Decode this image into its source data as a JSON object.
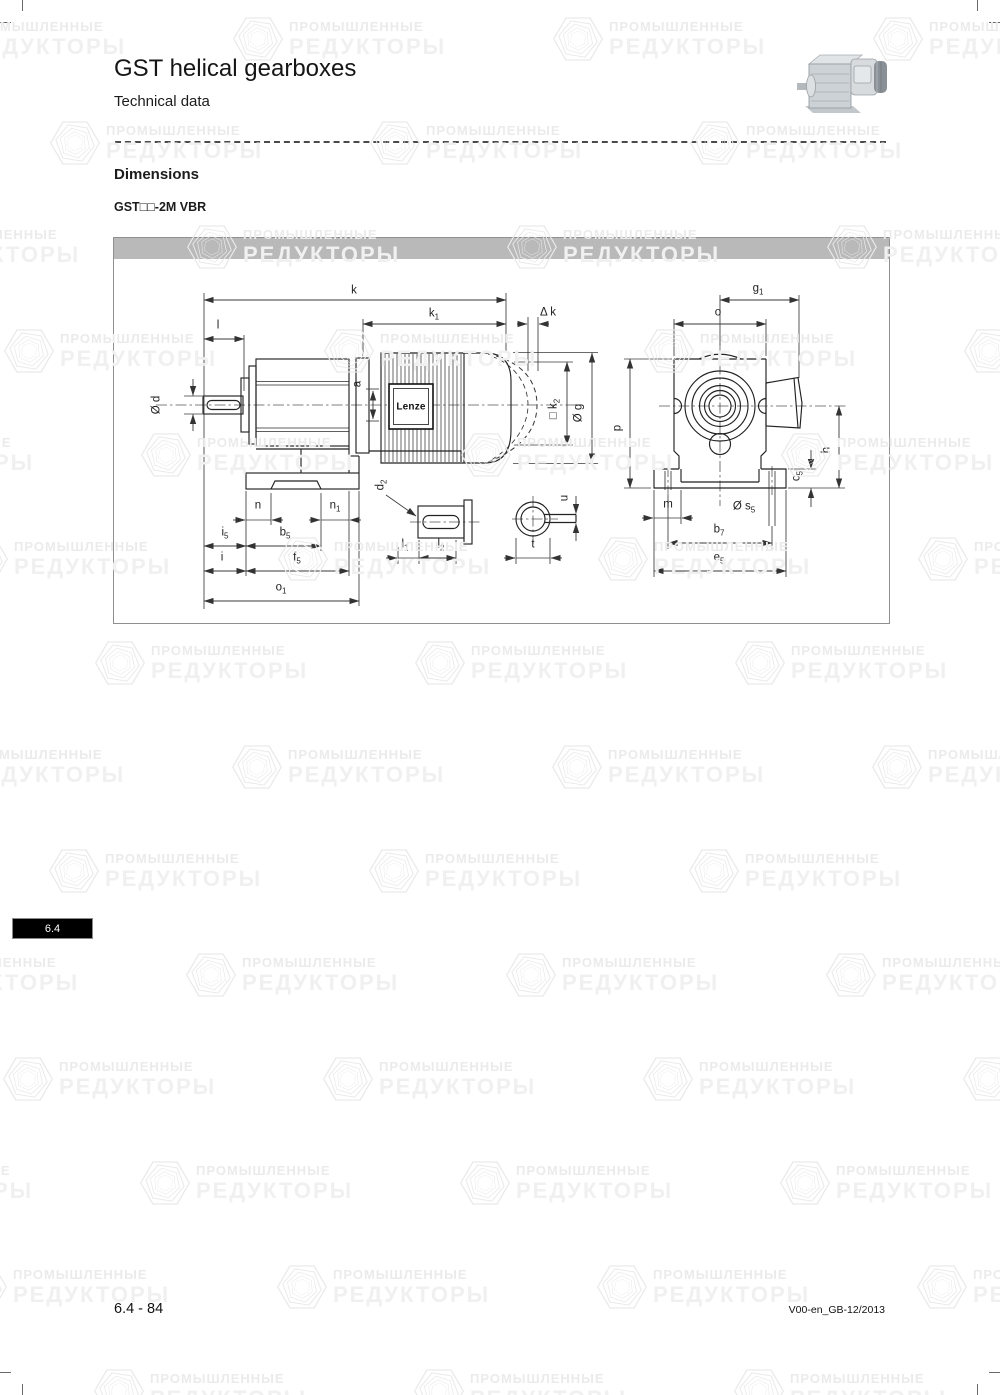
{
  "header": {
    "title": "GST helical gearboxes",
    "subtitle": "Technical data"
  },
  "section": {
    "heading": "Dimensions",
    "model": "GST□□-2M VBR"
  },
  "drawing": {
    "motor_brand": "Lenze",
    "labels": {
      "k": {
        "base": "k",
        "sub": ""
      },
      "k1": {
        "base": "k",
        "sub": "1"
      },
      "dk": {
        "base": "Δ k",
        "sub": ""
      },
      "l": {
        "base": "l",
        "sub": ""
      },
      "d": {
        "base": "Ø d",
        "sub": ""
      },
      "a": {
        "base": "a",
        "sub": ""
      },
      "k2": {
        "base": "□ k",
        "sub": "2"
      },
      "g": {
        "base": "Ø g",
        "sub": ""
      },
      "n": {
        "base": "n",
        "sub": ""
      },
      "n1": {
        "base": "n",
        "sub": "1"
      },
      "i5": {
        "base": "i",
        "sub": "5"
      },
      "b5": {
        "base": "b",
        "sub": "5"
      },
      "i": {
        "base": "i",
        "sub": ""
      },
      "f5": {
        "base": "f",
        "sub": "5"
      },
      "o1": {
        "base": "o",
        "sub": "1"
      },
      "d2": {
        "base": "d",
        "sub": "2"
      },
      "l1": {
        "base": "l",
        "sub": "1"
      },
      "l2": {
        "base": "l",
        "sub": "2"
      },
      "u": {
        "base": "u",
        "sub": ""
      },
      "t": {
        "base": "t",
        "sub": ""
      },
      "g1": {
        "base": "g",
        "sub": "1"
      },
      "o": {
        "base": "o",
        "sub": ""
      },
      "p": {
        "base": "p",
        "sub": ""
      },
      "h": {
        "base": "h",
        "sub": ""
      },
      "c5": {
        "base": "c",
        "sub": "5"
      },
      "m": {
        "base": "m",
        "sub": ""
      },
      "s5": {
        "base": "Ø s",
        "sub": "5"
      },
      "b7": {
        "base": "b",
        "sub": "7"
      },
      "e5": {
        "base": "e",
        "sub": "5"
      }
    }
  },
  "tab": {
    "label": "6.4"
  },
  "footer": {
    "page": "6.4 - 84",
    "doc": "V00-en_GB-12/2013"
  },
  "watermark": {
    "line1": "ПРОМЫШЛЕННЫЕ",
    "line2": "РЕДУКТОРЫ"
  },
  "colors": {
    "header_bar": "#b9b9b9",
    "tab_bg": "#000000",
    "tab_text": "#ffffff",
    "line": "#222222",
    "watermark": "#ededed"
  }
}
